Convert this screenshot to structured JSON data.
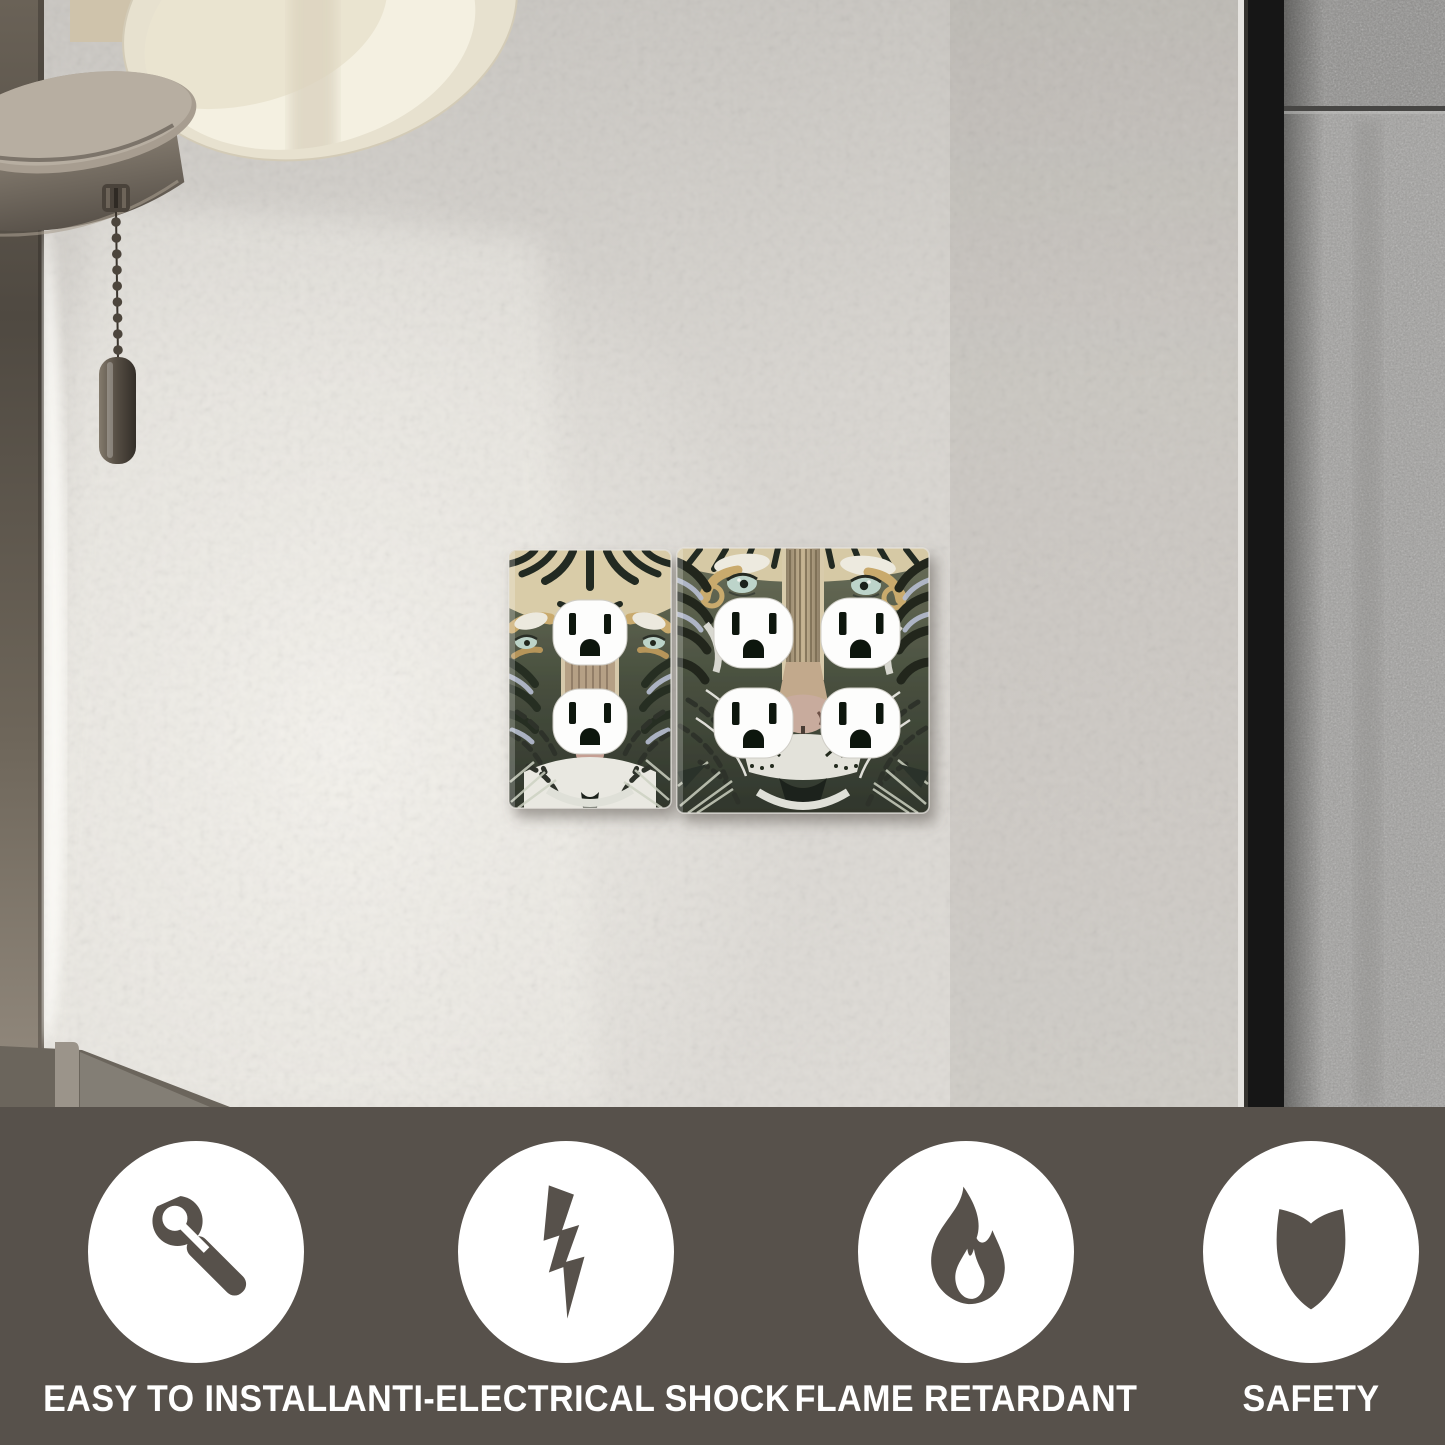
{
  "banner": {
    "background_color": "#57514b",
    "badge_color": "#ffffff",
    "text_color": "#ffffff",
    "features": [
      {
        "label": "EASY TO INSTALL",
        "icon": "wrench-icon"
      },
      {
        "label": "ANTI-ELECTRICAL SHOCK",
        "icon": "lightning-bolt-icon"
      },
      {
        "label": "FLAME RETARDANT",
        "icon": "flame-icon"
      },
      {
        "label": "SAFETY",
        "icon": "shield-icon"
      }
    ]
  },
  "scene": {
    "subject": "tiger-artwork duplex outlet wall plates on bedroom wall",
    "wall_plates": [
      {
        "name": "single-gang duplex wall plate",
        "receptacles": 2,
        "artwork": "tiger face"
      },
      {
        "name": "double-gang duplex wall plate",
        "receptacles": 4,
        "artwork": "tiger face"
      }
    ],
    "colors": {
      "wall": "#d8d5d0",
      "headboard_fabric": "#a1a09e",
      "headboard_frame": "#161616",
      "lamp_shade": "#ece6d6",
      "lamp_metal": "#6e665a",
      "plate_background": "#49503f",
      "receptacle": "#fdfdfc"
    }
  }
}
